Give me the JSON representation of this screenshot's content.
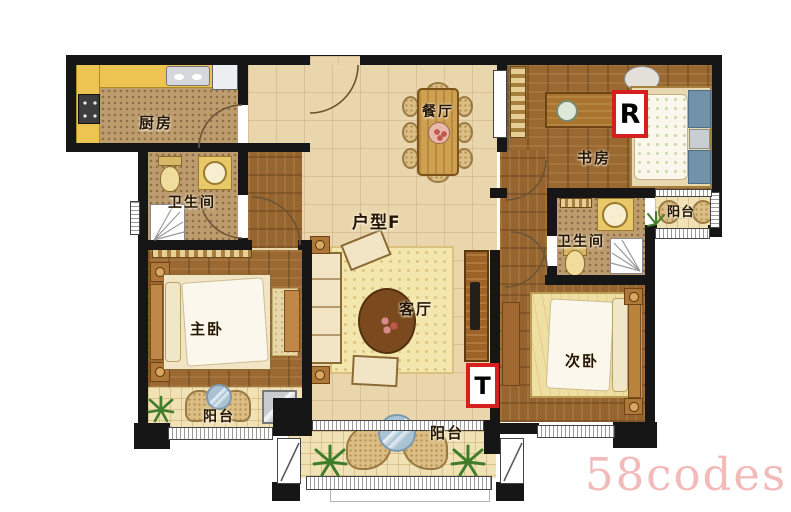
{
  "plan": {
    "unit_label": "户型F",
    "rooms": {
      "kitchen": {
        "label": "厨房"
      },
      "bath1": {
        "label": "卫生间"
      },
      "dining": {
        "label": "餐厅"
      },
      "study": {
        "label": "书房"
      },
      "bath2": {
        "label": "卫生间"
      },
      "living": {
        "label": "客厅"
      },
      "master_bedroom": {
        "label": "主卧"
      },
      "second_bedroom": {
        "label": "次卧"
      },
      "balcony_right": {
        "label": "阳台"
      },
      "balcony_left": {
        "label": "阳台"
      },
      "balcony_bottom": {
        "label": "阳台"
      }
    },
    "markers": {
      "r": "R",
      "t": "T"
    },
    "watermark": "58codes",
    "colors": {
      "wall": "#161616",
      "floor_tile": "#e9d6ad",
      "wood_floor": "#9a6831",
      "mosaic_floor": "#bd9c6e",
      "balcony_tile": "#f0e2b4",
      "counter_yellow": "#edc351",
      "marker_red": "#d62020",
      "watermark_pink": "#f3baba"
    }
  }
}
